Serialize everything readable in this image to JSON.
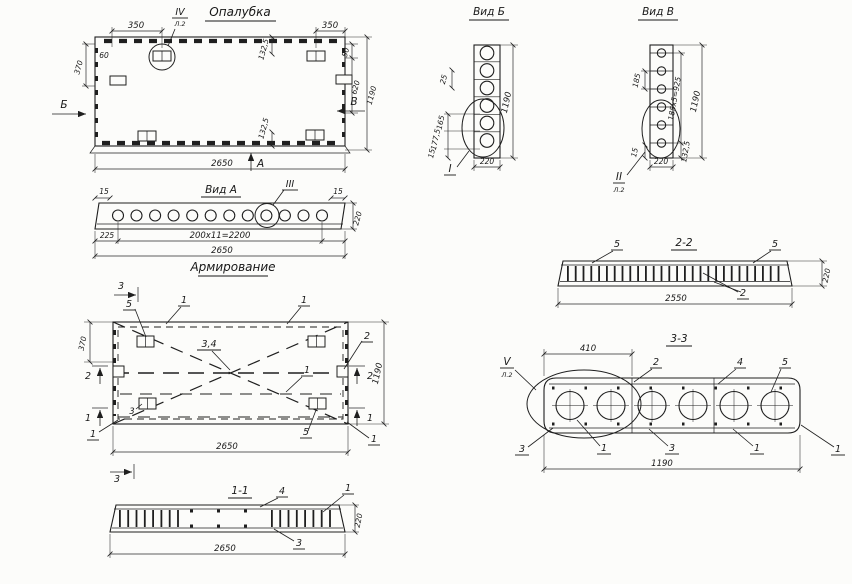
{
  "drawing": {
    "titles": {
      "formwork": "Опалубка",
      "view_a": "Вид А",
      "view_b": "Вид Б",
      "view_v": "Вид В",
      "reinforcement": "Армирование",
      "section_1_1": "1-1",
      "section_2_2": "2-2",
      "section_3_3": "3-3"
    },
    "formwork": {
      "dim_350_left": "350",
      "dim_350_right": "350",
      "dim_60": "60",
      "dim_370": "370",
      "dim_50": "50",
      "dim_620": "620",
      "dim_1190": "1190",
      "dim_132_top": "132,5",
      "dim_132_bottom": "132,5",
      "dim_2650": "2650",
      "arrow_left": "Б",
      "arrow_right": "В",
      "arrow_up": "А",
      "detail": "IV",
      "detail_sheet": "Л.2"
    },
    "view_a": {
      "dim_15_left": "15",
      "dim_15_right": "15",
      "detail": "III",
      "dim_225": "225",
      "dim_holes": "200х11=2200",
      "dim_2650": "2650",
      "dim_220": "220"
    },
    "view_b": {
      "dim_25": "25",
      "dim_165": "165",
      "dim_177": "177,5",
      "dim_15": "15",
      "dim_1190": "1190",
      "dim_220": "220",
      "detail": "I"
    },
    "view_v": {
      "dim_185": "185",
      "dim_15": "15",
      "dim_bolts": "185х5=925",
      "dim_132": "132,5",
      "dim_1190": "1190",
      "dim_220": "220",
      "detail": "II",
      "detail_sheet": "Л.2"
    },
    "reinforcement": {
      "cut_3_top": "3",
      "cut_3_bottom": "3",
      "cut_2_left": "2",
      "cut_2_right": "2",
      "cut_1_left": "1",
      "cut_1_right": "1",
      "pos_5_top": "5",
      "pos_1_top_left": "1",
      "pos_1_top_right": "1",
      "pos_2": "2",
      "pos_3_4": "3,4",
      "pos_1_mid_right": "1",
      "pos_3_plate": "3",
      "pos_5_bottom": "5",
      "pos_1_bottom_left": "1",
      "pos_1_bottom_right": "1",
      "dim_370": "370",
      "dim_1190": "1190",
      "dim_2650": "2650"
    },
    "section_1_1": {
      "pos_4": "4",
      "pos_1": "1",
      "pos_3": "3",
      "dim_2650": "2650",
      "dim_220": "220"
    },
    "section_2_2": {
      "pos_5_left": "5",
      "pos_5_right": "5",
      "pos_2": "2",
      "dim_2550": "2550",
      "dim_220": "220"
    },
    "section_3_3": {
      "detail": "V",
      "detail_sheet": "Л.2",
      "dim_410": "410",
      "pos_2": "2",
      "pos_4": "4",
      "pos_5": "5",
      "pos_3_left": "3",
      "pos_1_left": "1",
      "pos_3_mid": "3",
      "pos_1_mid": "1",
      "pos_1_right": "1",
      "dim_1190": "1190"
    }
  }
}
